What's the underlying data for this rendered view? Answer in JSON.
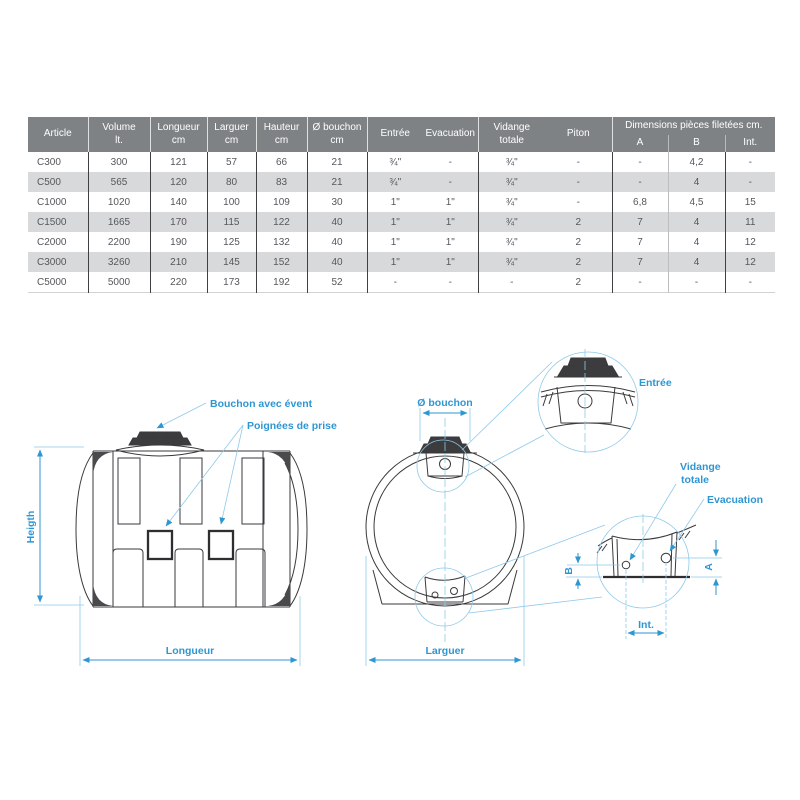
{
  "colors": {
    "accent_blue": "#2e96d2",
    "header_gray": "#7f8285",
    "row_alt_gray": "#d8d9da",
    "cell_text": "#55575a",
    "line_ink": "#3a3a3c"
  },
  "table": {
    "headers": {
      "article": "Article",
      "volume": [
        "Volume",
        "lt."
      ],
      "longueur": [
        "Longueur",
        "cm"
      ],
      "larguer": [
        "Larguer",
        "cm"
      ],
      "hauteur": [
        "Hauteur",
        "cm"
      ],
      "bouchon": [
        "Ø bouchon",
        "cm"
      ],
      "entree": "Entrée",
      "evacuation": "Evacuation",
      "vidange": [
        "Vidange",
        "totale"
      ],
      "piton": "Piton",
      "dimensions_group": "Dimensions pièces filetées cm.",
      "dim_a": "A",
      "dim_b": "B",
      "dim_int": "Int."
    },
    "rows": [
      [
        "C300",
        "300",
        "121",
        "57",
        "66",
        "21",
        "¾\"",
        "-",
        "¾\"",
        "-",
        "-",
        "4,2",
        "-"
      ],
      [
        "C500",
        "565",
        "120",
        "80",
        "83",
        "21",
        "¾\"",
        "-",
        "¾\"",
        "-",
        "-",
        "4",
        "-"
      ],
      [
        "C1000",
        "1020",
        "140",
        "100",
        "109",
        "30",
        "1\"",
        "1\"",
        "¾\"",
        "-",
        "6,8",
        "4,5",
        "15"
      ],
      [
        "C1500",
        "1665",
        "170",
        "115",
        "122",
        "40",
        "1\"",
        "1\"",
        "¾\"",
        "2",
        "7",
        "4",
        "11"
      ],
      [
        "C2000",
        "2200",
        "190",
        "125",
        "132",
        "40",
        "1\"",
        "1\"",
        "¾\"",
        "2",
        "7",
        "4",
        "12"
      ],
      [
        "C3000",
        "3260",
        "210",
        "145",
        "152",
        "40",
        "1\"",
        "1\"",
        "¾\"",
        "2",
        "7",
        "4",
        "12"
      ],
      [
        "C5000",
        "5000",
        "220",
        "173",
        "192",
        "52",
        "-",
        "-",
        "-",
        "2",
        "-",
        "-",
        "-"
      ]
    ]
  },
  "drawings": {
    "side_view": {
      "label_cap": "Bouchon avec évent",
      "label_handles": "Poignées de prise",
      "dim_height": "Heigth",
      "dim_length": "Longueur"
    },
    "front_view": {
      "dim_cap": "Ø bouchon",
      "dim_width": "Larguer"
    },
    "detail_top": {
      "label": "Entrée"
    },
    "detail_bottom": {
      "label_drain_line1": "Vidange",
      "label_drain_line2": "totale",
      "label_outlet": "Evacuation",
      "dim_a": "A",
      "dim_b": "B",
      "dim_int": "Int."
    }
  }
}
